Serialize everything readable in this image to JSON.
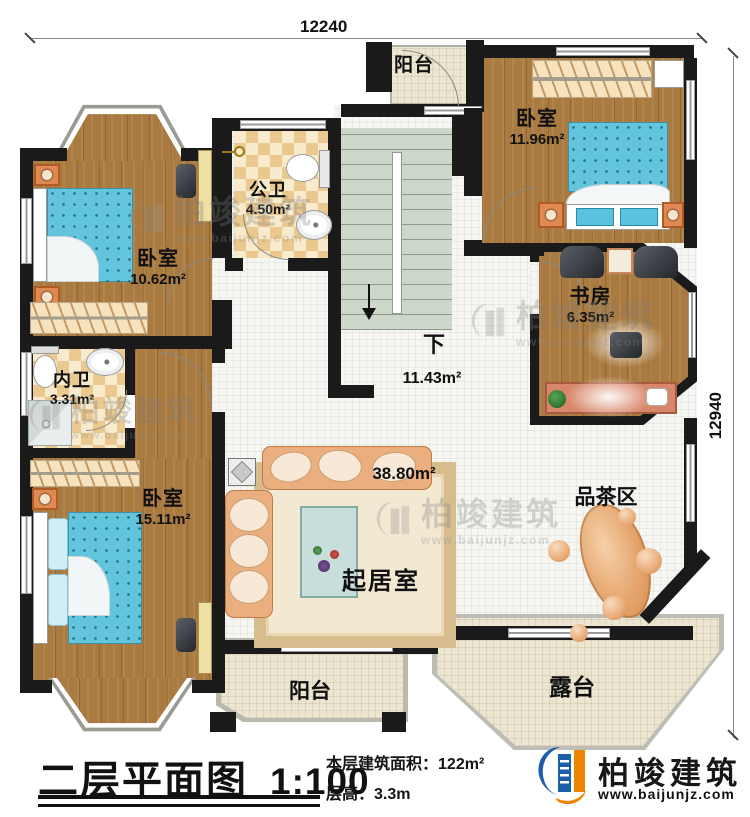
{
  "titleblock": {
    "title": "二层平面图",
    "scale": "1:100",
    "stats": [
      {
        "label": "本层建筑面积：",
        "value": "122m²"
      },
      {
        "label": "层高：",
        "value": "3.3m"
      }
    ]
  },
  "dimensions": {
    "top": "12240",
    "right": "12940"
  },
  "rooms": {
    "balcony_top": {
      "name": "阳台"
    },
    "bedroom_tr": {
      "name": "卧室",
      "area": "11.96m²"
    },
    "public_bath": {
      "name": "公卫",
      "area": "4.50m²"
    },
    "bedroom_tl": {
      "name": "卧室",
      "area": "10.62m²"
    },
    "study": {
      "name": "书房",
      "area": "6.35m²"
    },
    "private_bath": {
      "name": "内卫",
      "area": "3.31m²"
    },
    "stairs": {
      "name": "下",
      "area": "11.43m²"
    },
    "bedroom_bl": {
      "name": "卧室",
      "area": "15.11m²"
    },
    "living": {
      "name": "起居室",
      "area": "38.80m²"
    },
    "tea_area": {
      "name": "品茶区"
    },
    "balcony_bottom": {
      "name": "阳台"
    },
    "terrace": {
      "name": "露台"
    }
  },
  "brand": {
    "name": "柏竣建筑",
    "url": "www.baijunjz.com"
  },
  "watermark": {
    "name": "柏竣建筑",
    "url": "www.baijunjz.com"
  },
  "colors": {
    "wall": "#1a1a1a",
    "wood": "#aa7b40",
    "bath_tile": "#ebc88e",
    "stairs": "#cdd8cb",
    "bed": "#62c4dd",
    "sofa": "#eaae7f",
    "brand_blue": "#1a5fa8",
    "brand_orange": "#f08300"
  }
}
